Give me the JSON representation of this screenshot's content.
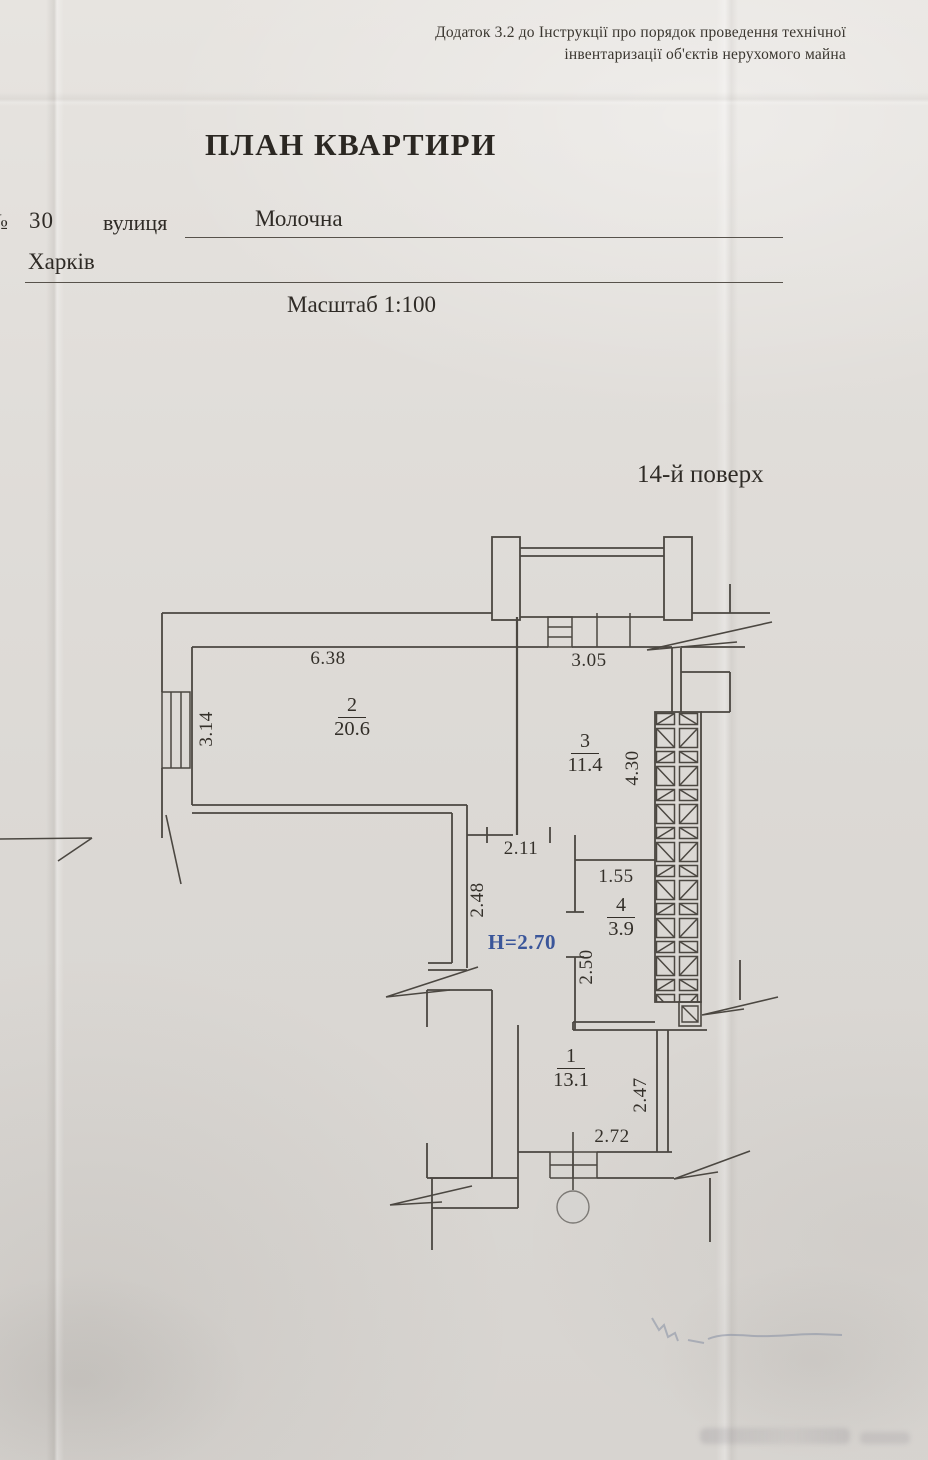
{
  "document": {
    "annex_note_line1": "Додаток 3.2 до Інструкції про порядок проведення технічної",
    "annex_note_line2": "інвентаризації об'єктів нерухомого майна",
    "title": "ПЛАН КВАРТИРИ",
    "address": {
      "number_sign": "№",
      "house_number": "30",
      "street_label": "вулиця",
      "street_name": "Молочна",
      "city": "Харків"
    },
    "scale_label": "Масштаб 1:100",
    "floor_label": "14-й поверх"
  },
  "plan": {
    "rooms": [
      {
        "number": "1",
        "area": "13.1"
      },
      {
        "number": "2",
        "area": "20.6"
      },
      {
        "number": "3",
        "area": "11.4"
      },
      {
        "number": "4",
        "area": "3.9"
      }
    ],
    "dimensions": {
      "room2_top_width": "6.38",
      "room3_top_width": "3.05",
      "room2_window_width": "3.14",
      "shaft_side_height": "4.30",
      "corridor_width": "2.11",
      "corridor_depth": "2.48",
      "room4_width": "1.55",
      "room4_depth": "2.50",
      "room1_depth": "2.47",
      "room1_width": "2.72"
    },
    "ceiling_height_note": "H=2.70",
    "colors": {
      "ink": "#4b4741",
      "height_note_blue": "#3a569a"
    }
  }
}
